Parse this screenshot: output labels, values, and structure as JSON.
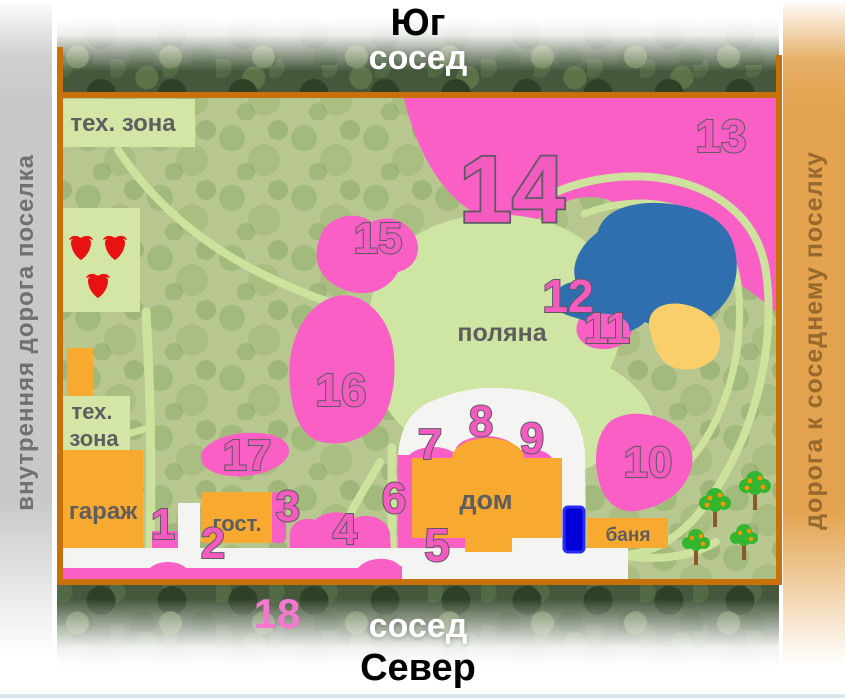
{
  "header": {
    "direction": "Юг",
    "neighbor": "сосед"
  },
  "footer": {
    "neighbor": "сосед",
    "direction": "Север"
  },
  "roads": {
    "left_label": "внутренняя дорога поселка",
    "right_label": "дорога к соседнему поселку"
  },
  "map": {
    "areas": {
      "tech_zone_top": "тех. зона",
      "tech_zone_left_line1": "тех.",
      "tech_zone_left_line2": "зона",
      "garage": "гараж",
      "guest_house": "гост.",
      "house": "дом",
      "bathhouse": "баня",
      "meadow": "поляна"
    },
    "zone_numbers": [
      {
        "label": "1"
      },
      {
        "label": "2"
      },
      {
        "label": "3"
      },
      {
        "label": "4"
      },
      {
        "label": "5"
      },
      {
        "label": "6"
      },
      {
        "label": "7"
      },
      {
        "label": "8"
      },
      {
        "label": "9"
      },
      {
        "label": "10"
      },
      {
        "label": "11"
      },
      {
        "label": "12"
      },
      {
        "label": "13"
      },
      {
        "label": "14"
      },
      {
        "label": "15"
      },
      {
        "label": "16"
      },
      {
        "label": "17"
      },
      {
        "label": "18"
      }
    ]
  },
  "colors": {
    "plot_border": "#c8700a",
    "zone_pink": "#f95fc5",
    "building_orange": "#f8a930",
    "meadow_green": "#cfe5a3",
    "pond_blue": "#2f6fb0",
    "sand_yellow": "#f9cf6b",
    "car_blue": "#0000d8",
    "left_road_gray": "#c8c8c8",
    "right_road_tan": "#e3a24d"
  }
}
